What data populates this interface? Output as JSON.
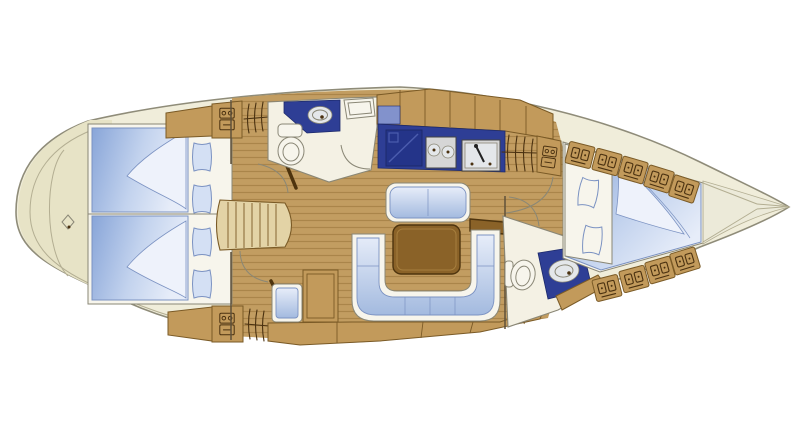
{
  "diagram": {
    "label": "Sailing yacht interior layout plan, top-down view, bow to the right",
    "type": "yacht-interior-floor-plan",
    "orientation": {
      "bow": "right",
      "stern": "left",
      "view": "top-down"
    },
    "areas": [
      {
        "id": "stern-lazarette",
        "label": "Stern / lazarette",
        "icons": [
          "rudder-post-marker-icon"
        ]
      },
      {
        "id": "aft-cabin",
        "label": "Aft double cabin",
        "features": [
          "double berth (two mattresses)",
          "4 pillows",
          "2 folded sheets",
          "shelf",
          "dresser cabinet x2",
          "hanging locker x2"
        ]
      },
      {
        "id": "companionway",
        "label": "Companionway steps",
        "steps": 7,
        "doors": 2
      },
      {
        "id": "aft-head",
        "label": "Aft head (bathroom)",
        "features": [
          "washbasin in counter",
          "marine toilet",
          "deck hatch",
          "door"
        ]
      },
      {
        "id": "galley",
        "label": "Galley",
        "features": [
          "top-loading icebox",
          "two-burner stove",
          "sink with faucet",
          "stowage band"
        ]
      },
      {
        "id": "salon",
        "label": "Salon",
        "features": [
          "bench settee",
          "U-shaped settee",
          "dining table",
          "side shelf",
          "stowage lockers"
        ]
      },
      {
        "id": "nav-station",
        "label": "Navigation station",
        "features": [
          "chart table",
          "seat"
        ]
      },
      {
        "id": "forward-head",
        "label": "Forward head (bathroom)",
        "features": [
          "marine toilet",
          "washbasin in counter",
          "door"
        ]
      },
      {
        "id": "forward-cabin",
        "label": "Forward V-berth cabin",
        "features": [
          "V-berth",
          "2 pillows",
          "folded sheet",
          "locker row port x5",
          "locker row starboard x4",
          "hanging locker",
          "dresser cabinet"
        ]
      },
      {
        "id": "anchor-locker",
        "label": "Bow anchor locker"
      }
    ]
  },
  "colors": {
    "bg": "#ffffff",
    "outline": "#8f8c79",
    "hull": "#f0edda",
    "stern": "#e7e3c6",
    "anchor": "#ecead9",
    "deckline": "#b3ae92",
    "wood": "#c29a5b",
    "wood-dark": "#7a5a26",
    "wood-light": "#e3d3a6",
    "floor": "#c29d61",
    "floor-stripe": "#aa854a",
    "table": "#8a6228",
    "table-dark": "#4e340e",
    "navy": "#2e3e95",
    "navy-dark": "#1d2a6b",
    "fridge": "#243489",
    "panel-blue": "#8292cc",
    "berth-blue": "#88a5d8",
    "berth-mid": "#c3d3ee",
    "berth-light": "#e7edf9",
    "cushion-deep": "#a3badf",
    "cushion-edge": "#7b92c2",
    "sheet": "#eef2fb",
    "pillow": "#d4e0f4",
    "fixture": "#f7f5ec",
    "room": "#f4f1e4",
    "steel": "#d6d6d6",
    "steel-light": "#e4e7ea",
    "steel-dark": "#444444",
    "glyph": "#4a3110",
    "wall-grey": "#8a8776",
    "wall-dark": "#5f513a"
  }
}
